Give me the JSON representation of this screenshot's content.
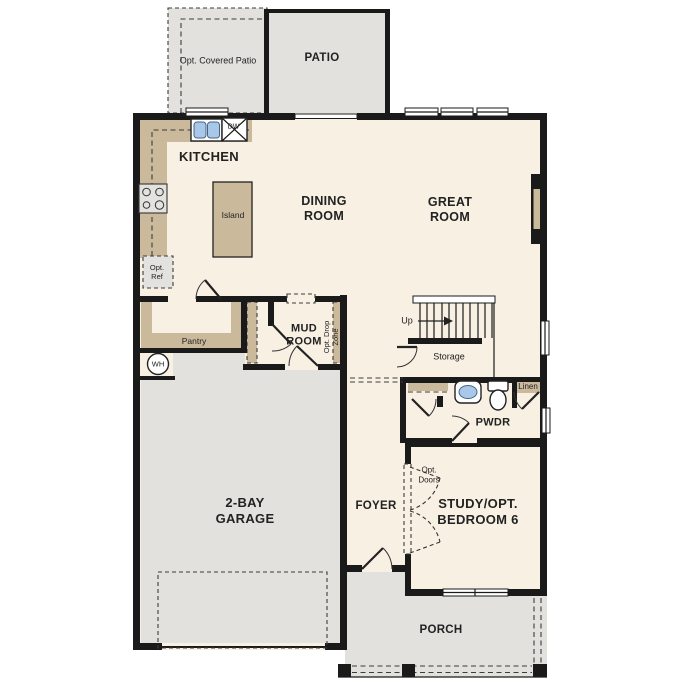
{
  "title": "First floor plan",
  "colors": {
    "page": "#ffffff",
    "floor": "#f8f0e3",
    "hard": "#e2e1de",
    "cab": "#cbb99c",
    "wall": "#1a1a1a",
    "line": "#3c3c3c",
    "sink": "#a9c7e6",
    "appl": "#e3e2df",
    "text": "#222222"
  },
  "labels": {
    "opt_covered_patio": "Opt. Covered Patio",
    "patio": "PATIO",
    "kitchen": "KITCHEN",
    "dw": "DW",
    "island": "Island",
    "dining": "DINING\nROOM",
    "great": "GREAT\nROOM",
    "opt_ref": "Opt.\nRef",
    "pantry": "Pantry",
    "mud": "MUD\nROOM",
    "opt_drop": "Opt. Drop\nZone",
    "up": "Up",
    "storage": "Storage",
    "linen": "Linen",
    "pwdr": "PWDR",
    "wh": "WH",
    "garage": "2-BAY\nGARAGE",
    "foyer": "FOYER",
    "opt_doors": "Opt.\nDoors",
    "study": "STUDY/OPT.\nBEDROOM 6",
    "porch": "PORCH"
  }
}
